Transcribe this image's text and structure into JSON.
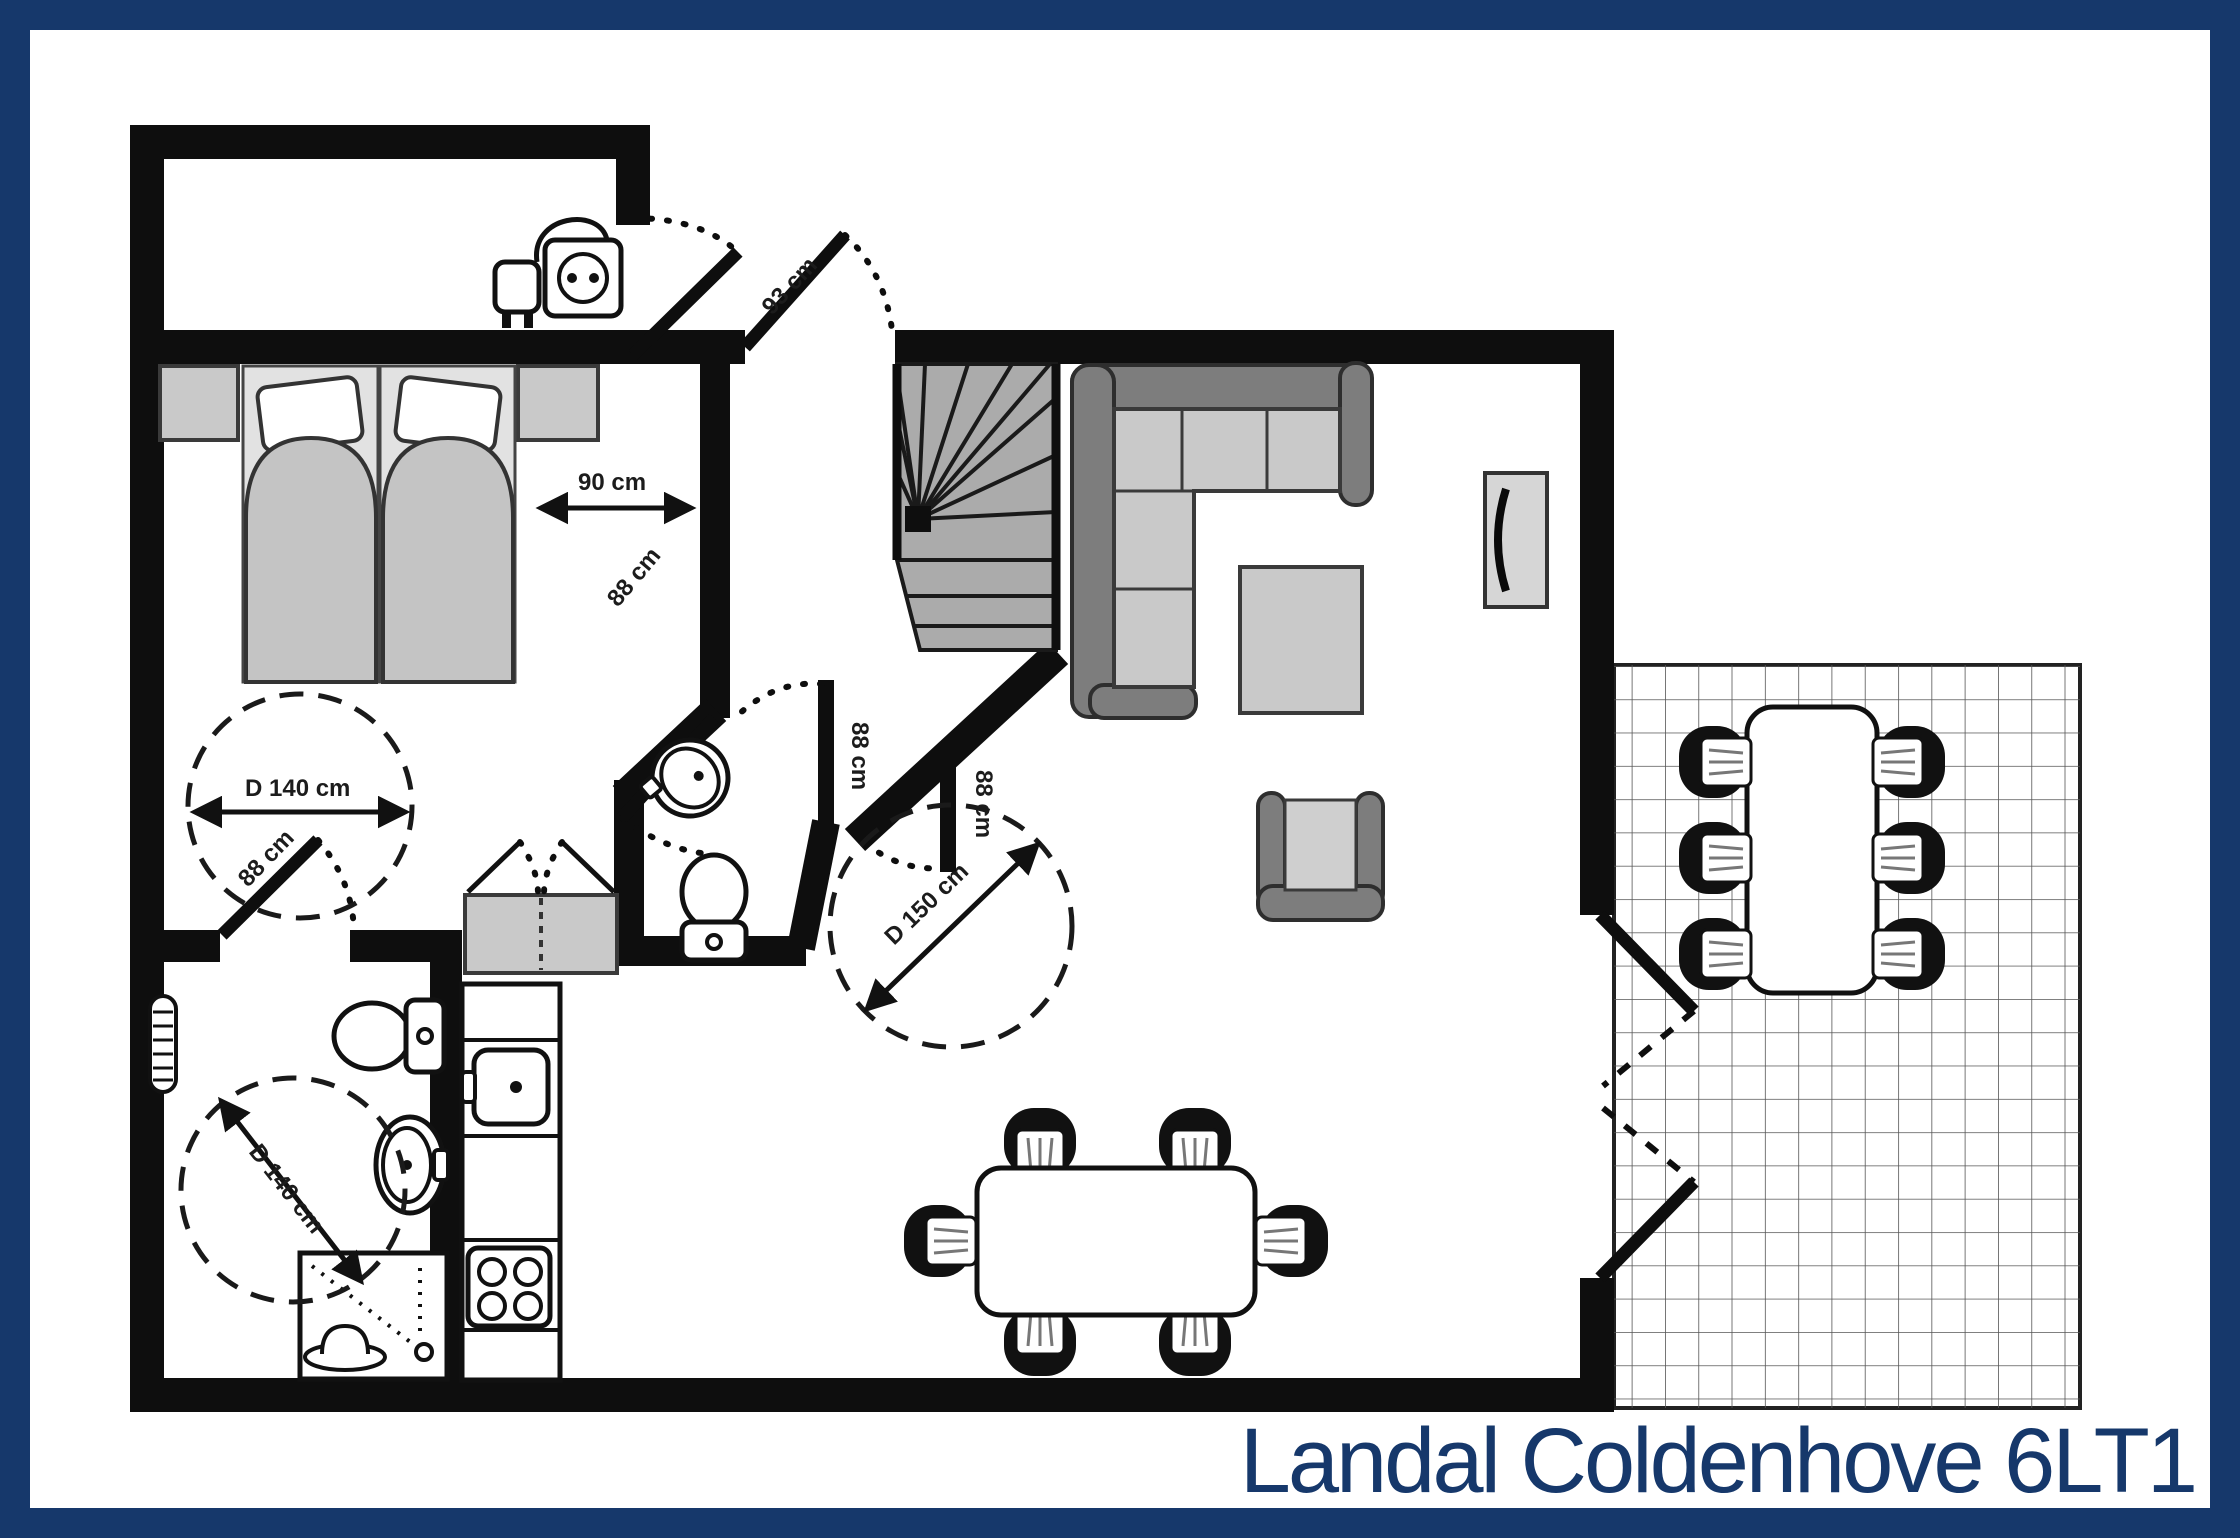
{
  "title": "Landal Coldenhove 6LT1",
  "colors": {
    "frame": "#16386b",
    "title_text": "#16386b",
    "wall": "#0e0e0e",
    "furniture_light": "#c9c9c9",
    "furniture_mid": "#b5b5b5",
    "furniture_dark": "#7d7d7d",
    "stairs": "#ababab"
  },
  "labels": {
    "entrance_door": "93 cm",
    "bed_passage": "90 cm",
    "bedroom_door": "88 cm",
    "hall_door": "88 cm",
    "living_door": "88 cm",
    "bathroom_door": "88 cm",
    "circle_bedroom": "D 140 cm",
    "circle_bathroom": "D 140 cm",
    "circle_hall": "D 150 cm"
  }
}
